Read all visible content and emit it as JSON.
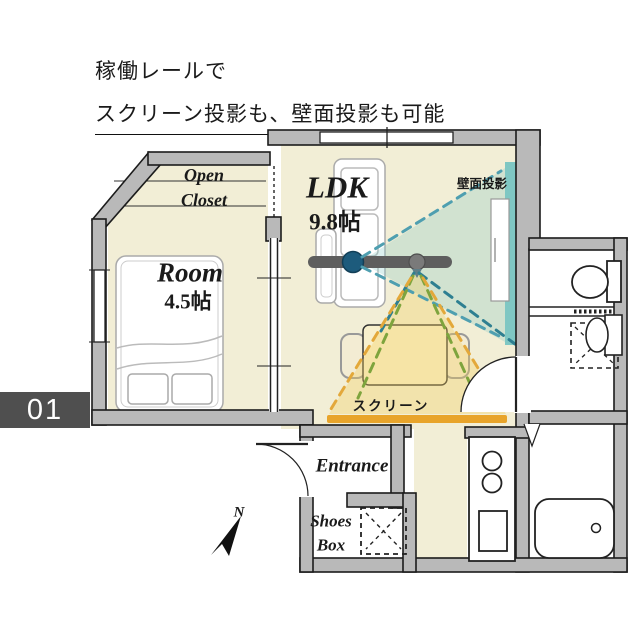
{
  "header": {
    "line1": "稼働レールで",
    "line2": "スクリーン投影も、壁面投影も可能"
  },
  "unit_badge": {
    "number": "01"
  },
  "floor_plan": {
    "rooms": {
      "ldk": {
        "name": "LDK",
        "size": "9.8帖"
      },
      "bedroom": {
        "name": "Room",
        "size": "4.5帖"
      },
      "open_closet": {
        "line1": "Open",
        "line2": "Closet"
      },
      "entrance": {
        "name": "Entrance"
      },
      "shoes_box": {
        "line1": "Shoes",
        "line2": "Box"
      }
    },
    "annotations": {
      "wall_projection": "壁面投影",
      "screen": "スクリーン",
      "compass": "N"
    },
    "colors": {
      "floor": "#f2eed6",
      "wall": "#b9b9b9",
      "screen_bar": "#e8a42a",
      "rail": "#5e5e5e",
      "projector_dot": "#1d5b7c",
      "wall_projection_strip": "#7fc7c3",
      "dash_teal": "#4f9fb0",
      "dash_dark_teal": "#2e7f91",
      "dash_green": "#7ea43d",
      "dash_yellow": "#e3a83a"
    }
  }
}
